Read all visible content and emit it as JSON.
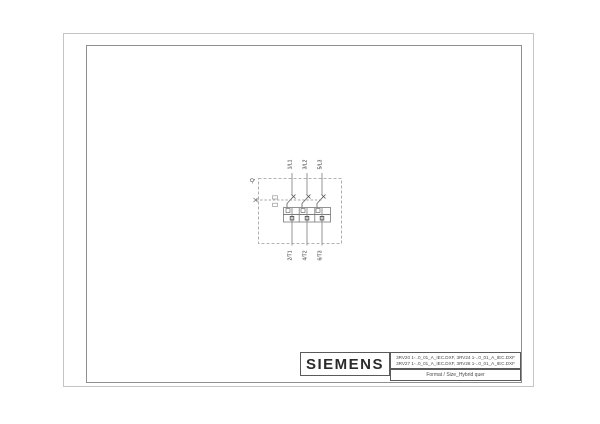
{
  "drawing": {
    "designation": "-Q",
    "top_terminals": [
      "1/L1",
      "3/L2",
      "5/L3"
    ],
    "bottom_terminals": [
      "2/T1",
      "4/T2",
      "6/T3"
    ]
  },
  "title_block": {
    "brand": "SIEMENS",
    "file_line1": "3RV20 1-..0_01_A_IEC.DXF, 3RV24 1-..0_01_A_IEC.DXF",
    "file_line2": "3RV27 1-..0_01_A_IEC.DXF, 3RV28 1-..0_01_A_IEC.DXF",
    "format_line": "Format / Size_Hybrid quer"
  },
  "colors": {
    "outer_frame": "#c4c4c4",
    "inner_frame": "#8f8f8f",
    "title_border": "#5a5a5a",
    "schematic_line": "#8a8a8a",
    "text": "#333333"
  }
}
